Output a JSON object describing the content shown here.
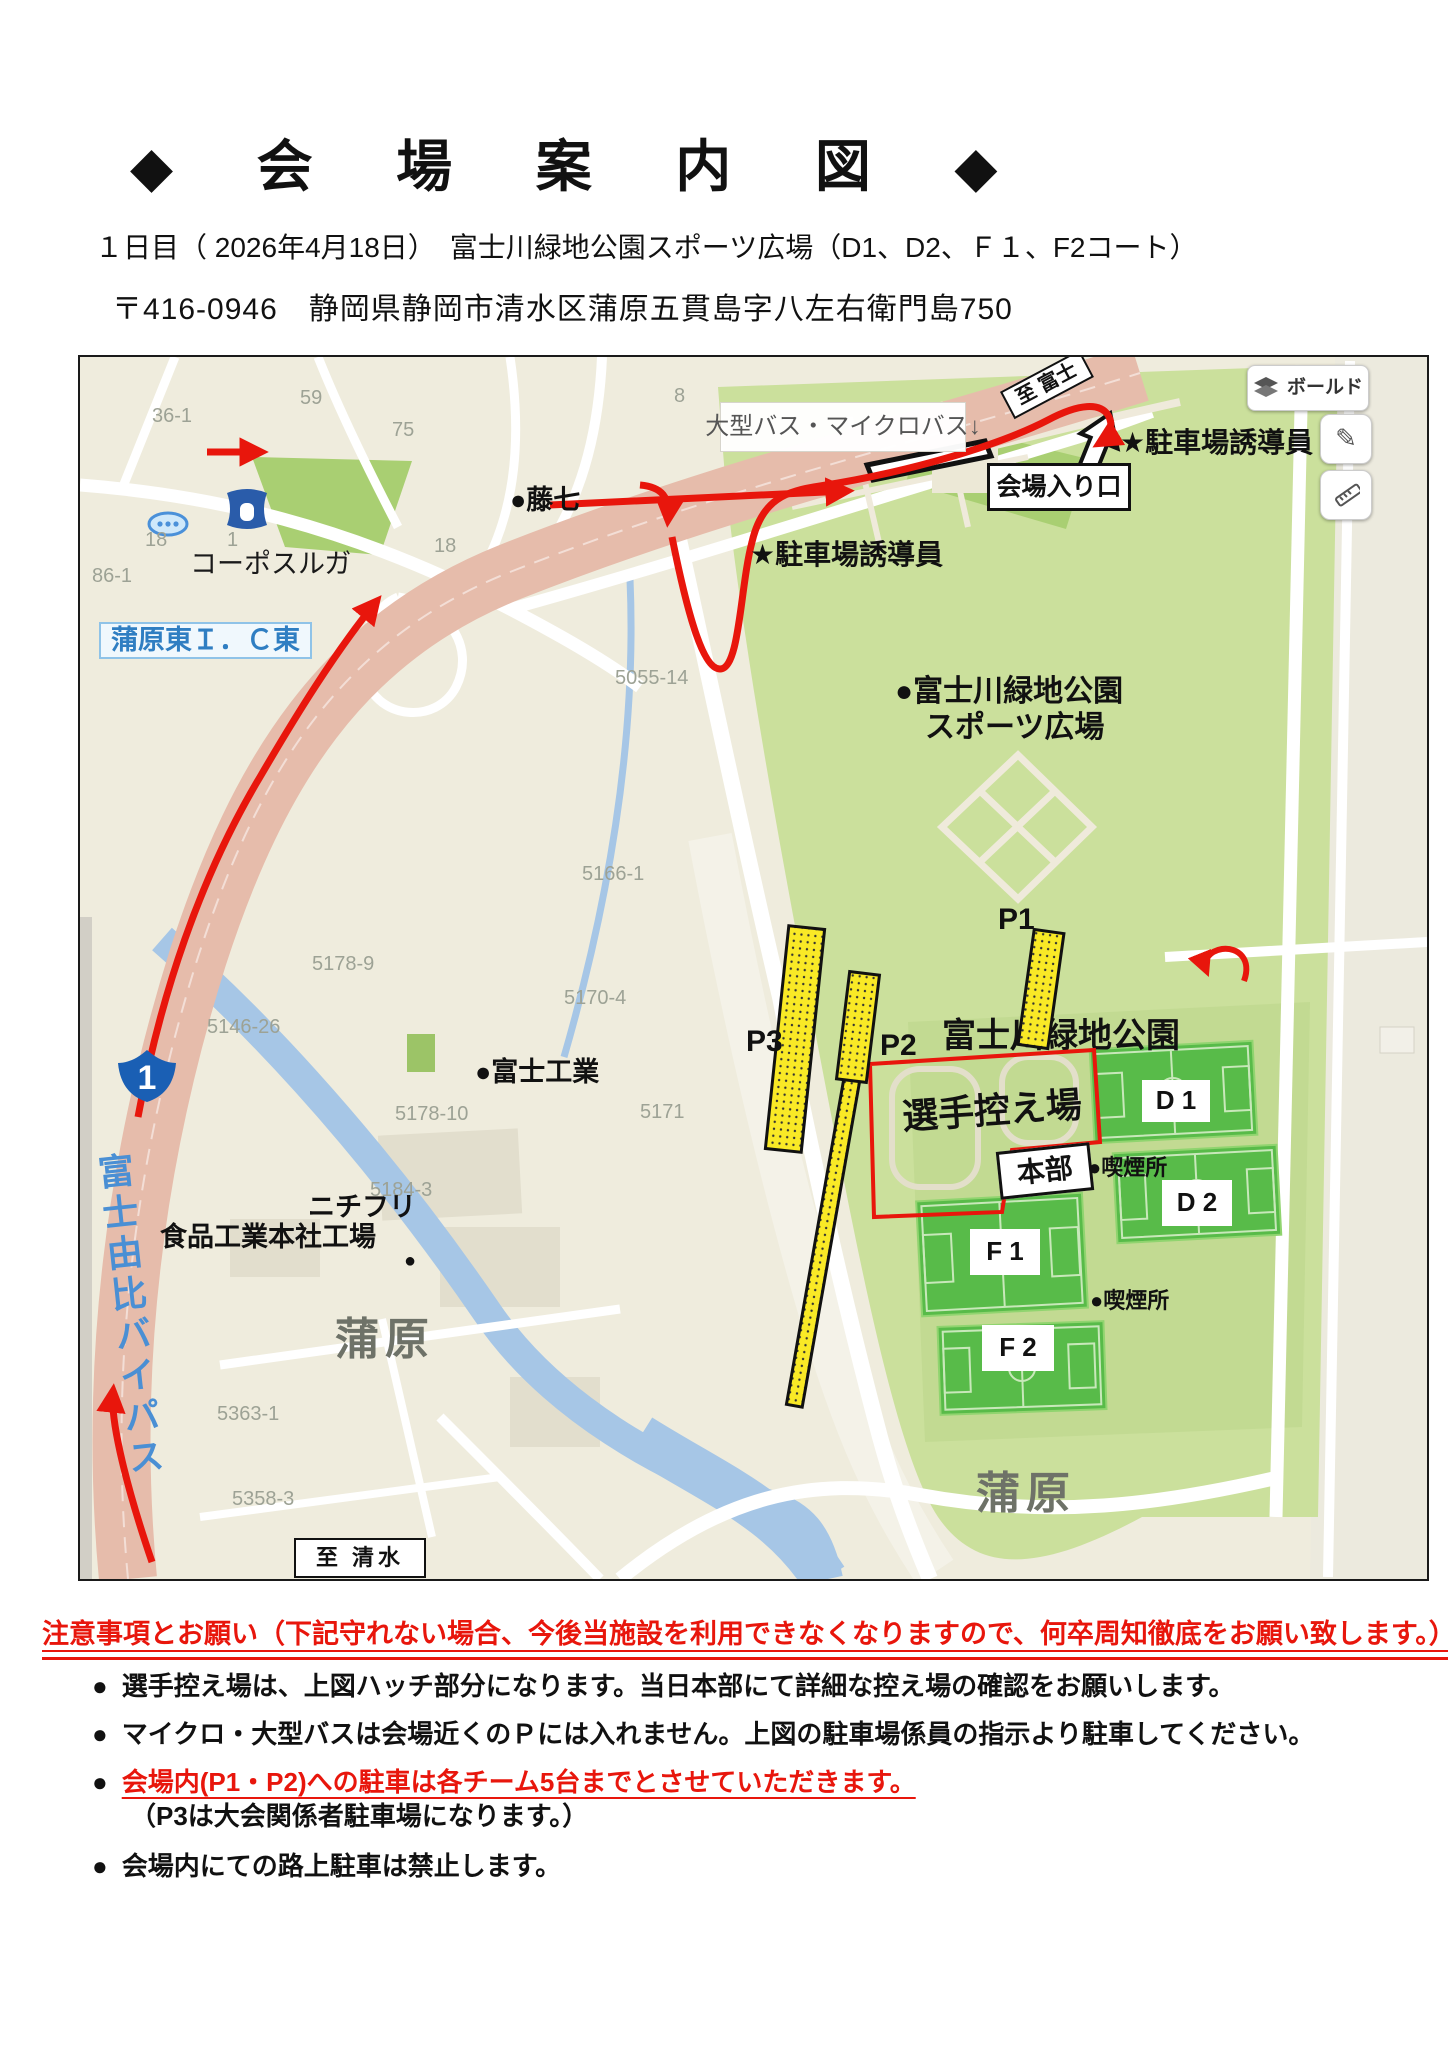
{
  "doc": {
    "title": "◆ 会 場 案 内 図 ◆",
    "subtitle": "１日目（ 2026年4月18日）　富士川緑地公園スポーツ広場（D1、D2、Ｆ１、F2コート）",
    "address": "〒416-0946　静岡県静岡市清水区蒲原五貫島字八左右衛門島750"
  },
  "map": {
    "controls": {
      "layers_label": "ボールド",
      "pencil_glyph": "✎"
    },
    "routes": {
      "to_fuji": "至 富士",
      "to_shimizu": "至 清水",
      "route_number": "1",
      "bypass": "富士由比バイパス"
    },
    "guides": {
      "bus_note": "大型バス・マイクロバス↓",
      "entrance": "会場入り口",
      "staff": "★駐車場誘導員"
    },
    "places": {
      "ic": "蒲原東Ｉ．Ｃ東",
      "corpo": "コーポスルガ",
      "fujishichi": "●藤七",
      "park_line1": "●富士川緑地公園",
      "park_line2": "スポーツ広場",
      "park_center": "富士川緑地公園",
      "nichifuri1": "ニチフリ",
      "nichifuri2": "食品工業本社工場",
      "marker_dot": "●",
      "fuji_kogyo": "●富士工業",
      "kambara": "蒲原"
    },
    "venue": {
      "p1": "P1",
      "p2": "P2",
      "p3": "P3",
      "d1": "D 1",
      "d2": "D 2",
      "f1": "F 1",
      "f2": "F 2",
      "waiting_area": "選手控え場",
      "hq": "本部",
      "smoking": "●喫煙所"
    },
    "parcel_numbers": [
      "36-1",
      "59",
      "75",
      "8",
      "18",
      "1",
      "18",
      "86-1",
      "5055-14",
      "5166-1",
      "5178-9",
      "5170-4",
      "5146-26",
      "5178-10",
      "5171",
      "5184-3",
      "5363-1",
      "5358-3"
    ],
    "colors": {
      "route_red": "#e8160c",
      "parking_yellow": "#f9e926",
      "field_green": "#58bb49",
      "park_green": "#cbe09c",
      "highway_pink": "#e6bcab",
      "river_blue": "#a6c6e6",
      "label_blue": "#2f7ec2"
    }
  },
  "notes": {
    "heading": "注意事項とお願い（下記守れない場合、今後当施設を利用できなくなりますので、何卒周知徹底をお願い致します。）",
    "bullet": "●",
    "items": [
      {
        "text": "選手控え場は、上図ハッチ部分になります。当日本部にて詳細な控え場の確認をお願いします。"
      },
      {
        "text": "マイクロ・大型バスは会場近くのＰには入れません。上図の駐車場係員の指示より駐車してください。"
      },
      {
        "text": "会場内(P1・P2)への駐車は各チーム5台までとさせていただきます。",
        "sub": "（P3は大会関係者駐車場になります。）"
      },
      {
        "text": "会場内にての路上駐車は禁止します。"
      }
    ]
  }
}
